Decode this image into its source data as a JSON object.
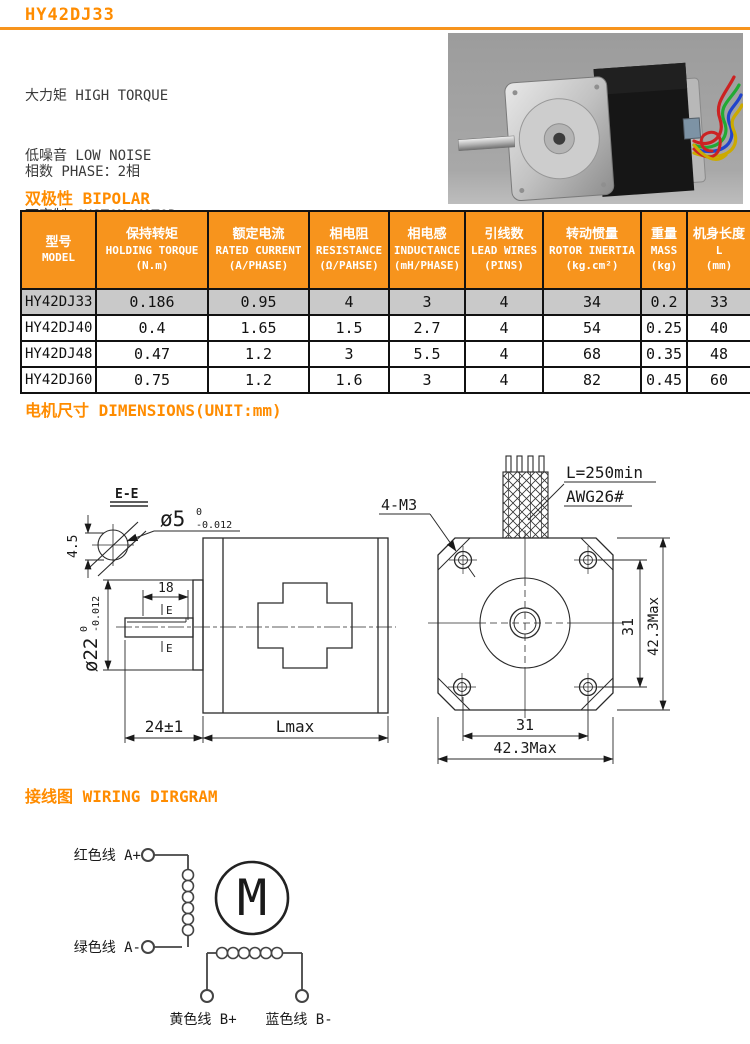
{
  "title": "HY42DJ33",
  "colors": {
    "accent_heading": "#FF8C00",
    "table_header_bg": "#F7941D",
    "highlight_row_bg": "#C9C9C9",
    "photo_wires": [
      "#cc2222",
      "#22aa33",
      "#2244cc",
      "#ccaa00"
    ]
  },
  "intro": {
    "features": [
      "大力矩 HIGH TORQUE",
      "低噪音 LOW NOISE",
      "可定制 CUSTOM MOTOR"
    ],
    "specs": [
      "相数 PHASE：2相",
      "步距角度 STEP ANGLE：1.8°",
      "机座尺寸 MOTOR FRAME SIZE：42x42mm"
    ]
  },
  "headings": {
    "bipolar": "双极性 BIPOLAR",
    "dimensions": "电机尺寸 DIMENSIONS(UNIT:mm)",
    "wiring": "接线图 WIRING DIRGRAM"
  },
  "table": {
    "headers": [
      {
        "cn": "型号",
        "en": "MODEL",
        "unit": ""
      },
      {
        "cn": "保持转矩",
        "en": "HOLDING TORQUE",
        "unit": "(N.m)"
      },
      {
        "cn": "额定电流",
        "en": "RATED CURRENT",
        "unit": "(A/PHASE)"
      },
      {
        "cn": "相电阻",
        "en": "RESISTANCE",
        "unit": "(Ω/PAHSE)"
      },
      {
        "cn": "相电感",
        "en": "INDUCTANCE",
        "unit": "(mH/PHASE)"
      },
      {
        "cn": "引线数",
        "en": "LEAD WIRES",
        "unit": "(PINS)"
      },
      {
        "cn": "转动惯量",
        "en": "ROTOR INERTIA",
        "unit": "(kg.cm²)"
      },
      {
        "cn": "重量",
        "en": "MASS",
        "unit": "(kg)"
      },
      {
        "cn": "机身长度",
        "en": "L",
        "unit": "(mm)"
      }
    ],
    "rows": [
      {
        "model": "HY42DJ33",
        "values": [
          "0.186",
          "0.95",
          "4",
          "3",
          "4",
          "34",
          "0.2",
          "33"
        ],
        "highlighted": true
      },
      {
        "model": "HY42DJ40",
        "values": [
          "0.4",
          "1.65",
          "1.5",
          "2.7",
          "4",
          "54",
          "0.25",
          "40"
        ],
        "highlighted": false
      },
      {
        "model": "HY42DJ48",
        "values": [
          "0.47",
          "1.2",
          "3",
          "5.5",
          "4",
          "68",
          "0.35",
          "48"
        ],
        "highlighted": false
      },
      {
        "model": "HY42DJ60",
        "values": [
          "0.75",
          "1.2",
          "1.6",
          "3",
          "4",
          "82",
          "0.45",
          "60"
        ],
        "highlighted": false
      }
    ]
  },
  "drawing": {
    "section_label": "E-E",
    "shaft_dia": "ø5",
    "shaft_tol_hi": "0",
    "shaft_tol_lo": "-0.012",
    "flat_dim": "4.5",
    "key_len": "18",
    "section_mark": "E",
    "boss_dia": "ø22",
    "boss_tol_hi": "0",
    "boss_tol_lo": "-0.012",
    "protrusion": "24±1",
    "body_len": "Lmax",
    "mount_holes": "4-M3",
    "lead_len": "L=250min",
    "wire_gauge": "AWG26#",
    "hole_pitch_v": "31",
    "frame_v": "42.3Max",
    "hole_pitch_h": "31",
    "frame_h": "42.3Max"
  },
  "wiring": {
    "a_plus": "红色线 A+",
    "a_minus": "绿色线 A-",
    "b_plus": "黄色线 B+",
    "b_minus": "蓝色线 B-",
    "motor": "M"
  }
}
